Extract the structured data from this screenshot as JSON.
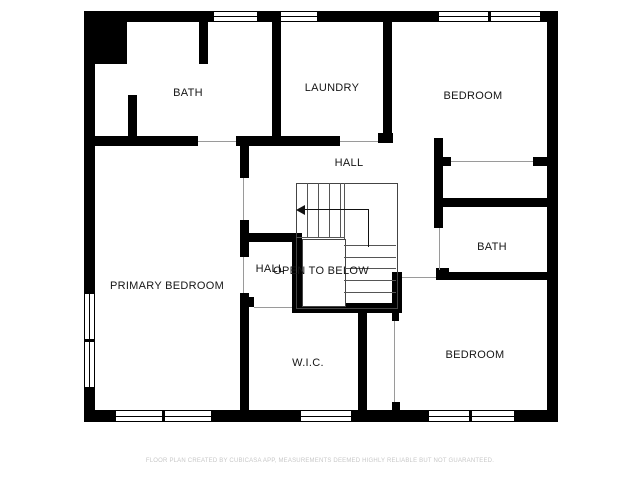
{
  "floorplan": {
    "rooms": [
      {
        "label": "BATH"
      },
      {
        "label": "LAUNDRY"
      },
      {
        "label": "BEDROOM"
      },
      {
        "label": "HALL"
      },
      {
        "label": "HALL"
      },
      {
        "label": "OPEN TO BELOW"
      },
      {
        "label": "BATH"
      },
      {
        "label": "PRIMARY BEDROOM"
      },
      {
        "label": "W.I.C."
      },
      {
        "label": "BEDROOM"
      }
    ],
    "stairs": {
      "direction_arrow": "left"
    },
    "footer_text": "FLOOR PLAN CREATED BY CUBICASA APP, MEASUREMENTS DEEMED HIGHLY RELIABLE BUT NOT GUARANTEED.",
    "colors": {
      "wall": "#000000",
      "background": "#ffffff",
      "label": "#161616",
      "footer": "#c8c8c8"
    }
  }
}
